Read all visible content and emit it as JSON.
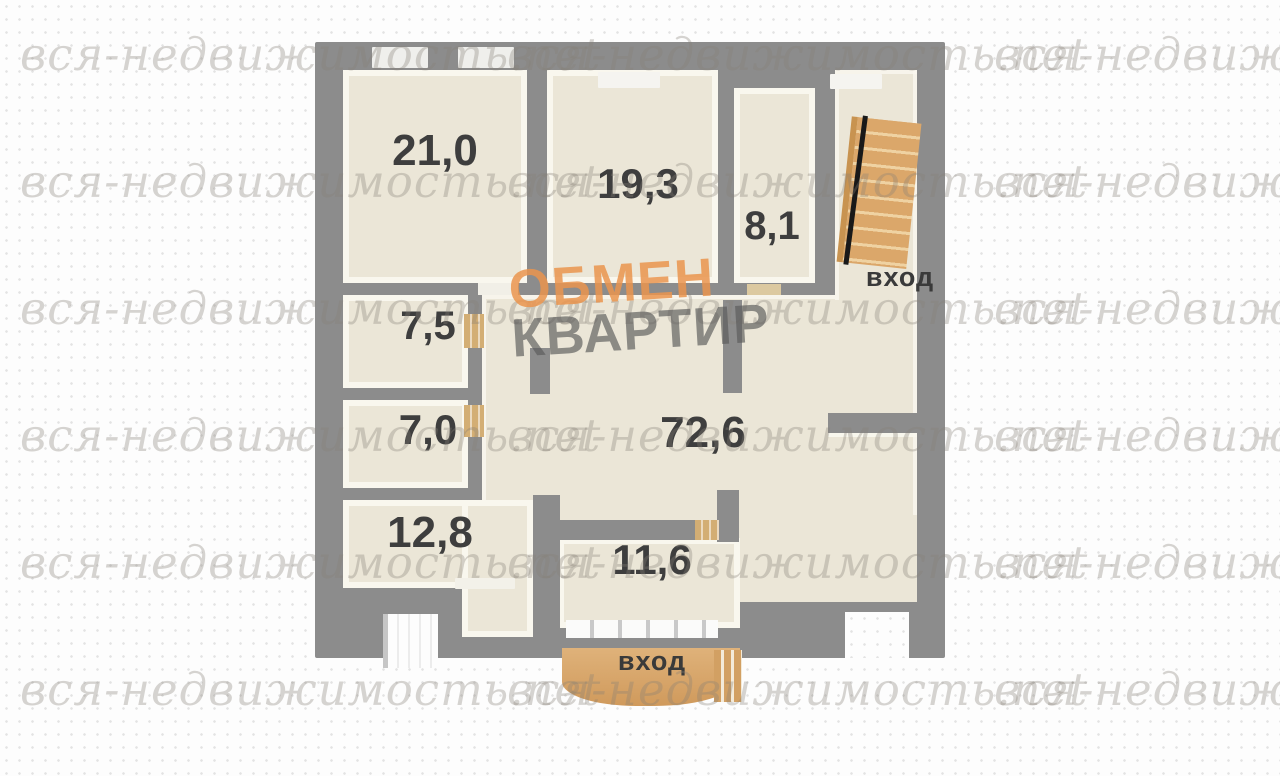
{
  "watermark": {
    "text": "вся-недвижимость.net"
  },
  "logo": {
    "line1": "ОБМЕН",
    "line2": "КВАРТИР"
  },
  "floorplan": {
    "rooms": [
      {
        "name": "room-top-left",
        "area": "21,0"
      },
      {
        "name": "room-top-center",
        "area": "19,3"
      },
      {
        "name": "room-top-right-small",
        "area": "8,1"
      },
      {
        "name": "room-mid-left-upper",
        "area": "7,5"
      },
      {
        "name": "room-mid-left-lower",
        "area": "7,0"
      },
      {
        "name": "room-central-hall",
        "area": "72,6"
      },
      {
        "name": "room-bottom-left",
        "area": "12,8"
      },
      {
        "name": "room-bottom-center",
        "area": "11,6"
      }
    ],
    "labels": {
      "entrance_top": "вход",
      "entrance_bottom": "вход"
    },
    "colors": {
      "wall": "#8c8c8c",
      "floor": "#ebe6d7",
      "floor_highlight": "#faf8f0",
      "stairs_wood": "#dba76a",
      "porch_wood": "#d7a468",
      "door_wood": "#d3ae74",
      "label_text": "#3e3e3e",
      "logo_orange": "#ea944e",
      "logo_gray": "#5a5a5a",
      "watermark_gray": "#d2d0cc"
    }
  }
}
